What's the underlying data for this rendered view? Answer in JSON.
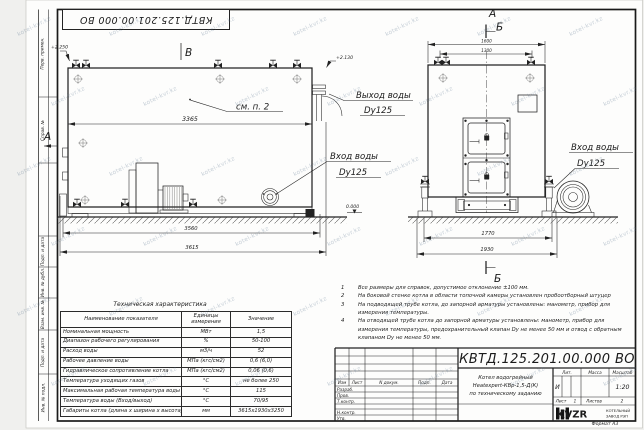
{
  "watermark": "kotel-kvr.kz",
  "frame": {
    "top_stamp": "КВТД.125.201.00.000 ВО",
    "format_label": "Формат  А3",
    "left_labels": [
      "Перв. примен.",
      "Справ. №",
      "Подп. и дата",
      "Инв. № дубл.",
      "Взам. инв. №",
      "Подп. и дата",
      "Инв. № подл."
    ]
  },
  "views": {
    "section_b_top": "В",
    "section_a_left": "А",
    "front_mark_a": "А",
    "front_mark_b": "Б",
    "front_mark_b_bottom": "Б",
    "see_note": "см. п. 2"
  },
  "elevations": {
    "top_left": "+2.250",
    "outlet": "+2.130",
    "ground": "0.000"
  },
  "labels": {
    "outlet_title": "Выход воды",
    "outlet_dn": "Dy125",
    "inlet_title": "Вход воды",
    "inlet_dn": "Dy125",
    "inlet2_title": "Вход воды",
    "inlet2_dn": "Dy125"
  },
  "dims": {
    "side_body": "3365",
    "side_base": "3560",
    "side_total": "3615",
    "front_top_outer": "1600",
    "front_top_inner": "1300",
    "front_base_inner": "1770",
    "front_base_outer": "1930"
  },
  "spec_table": {
    "title": "Техническая характеристика",
    "col_name": "Наименование показателя",
    "col_unit": "Единицы измерения",
    "col_value": "Значение",
    "rows": [
      {
        "name": "Номинальная мощность",
        "unit": "МВт",
        "value": "1,5"
      },
      {
        "name": "Диапазон рабочего регулирования",
        "unit": "%",
        "value": "50-100"
      },
      {
        "name": "Расход воды",
        "unit": "м3/ч",
        "value": "52"
      },
      {
        "name": "Рабочее давление воды",
        "unit": "МПа (кгс/см2)",
        "value": "0,6 (6,0)"
      },
      {
        "name": "Гидравлическое сопротивление котла",
        "unit": "МПа (кгс/см2)",
        "value": "0,06 (0,6)"
      },
      {
        "name": "Температура уходящих газов",
        "unit": "°С",
        "value": "не более 250"
      },
      {
        "name": "Максимальная рабочая температура воды",
        "unit": "°С",
        "value": "115"
      },
      {
        "name": "Температура воды (Вход/выход)",
        "unit": "°С",
        "value": "70/95"
      },
      {
        "name": "Габариты котла (длина х ширина х высота)",
        "unit": "мм",
        "value": "3615х1930х3250"
      }
    ]
  },
  "notes": {
    "items": [
      {
        "num": "1",
        "text": "Все размеры для справок, допустимое отклонение ±100 мм."
      },
      {
        "num": "2",
        "text": "На боковой стенке котла в области топочной камеры установлен пробоотборный штуцер"
      },
      {
        "num": "3",
        "text": "На  подводящей трубе котла, до запорной арматуры установлены: манометр, прибор для измерения температуры."
      },
      {
        "num": "4",
        "text": "На отводящей трубе котла до запорной арматуры установлены: манометр, прибор для измерения температуры, предохранительный клапан Dу не менее 50 мм и отвод с обратным клапаном Dу не менее 50 мм."
      }
    ]
  },
  "title_block": {
    "doc_number": "КВТД.125.201.00.000  ВО",
    "product_line1": "Котел водогрейный",
    "product_line2": "Heatexpert-КВр-1,5-Д(К)",
    "product_line3": "по техническому заданию",
    "col_izm": "Изм",
    "col_list": "Лист",
    "col_ndoc": "N докум.",
    "col_podp": "Подп.",
    "col_data": "Дата",
    "row_razrab": "Разраб.",
    "row_prov": "Пров.",
    "row_tkontr": "Т.контр.",
    "row_nkontr": "Н.контр.",
    "row_utv": "Утв.",
    "lit_label": "Лит.",
    "lit_value": "И",
    "massa_label": "Масса",
    "masshtab_label": "Масштаб",
    "scale_value": "1:20",
    "list_label": "Лист",
    "list_value": "1",
    "listov_label": "Листов",
    "listov_value": "2",
    "logo_text": "KVZR",
    "logo_line1": "КОТЕЛЬНЫЙ",
    "logo_line2": "ЗАВОД РЭП"
  }
}
